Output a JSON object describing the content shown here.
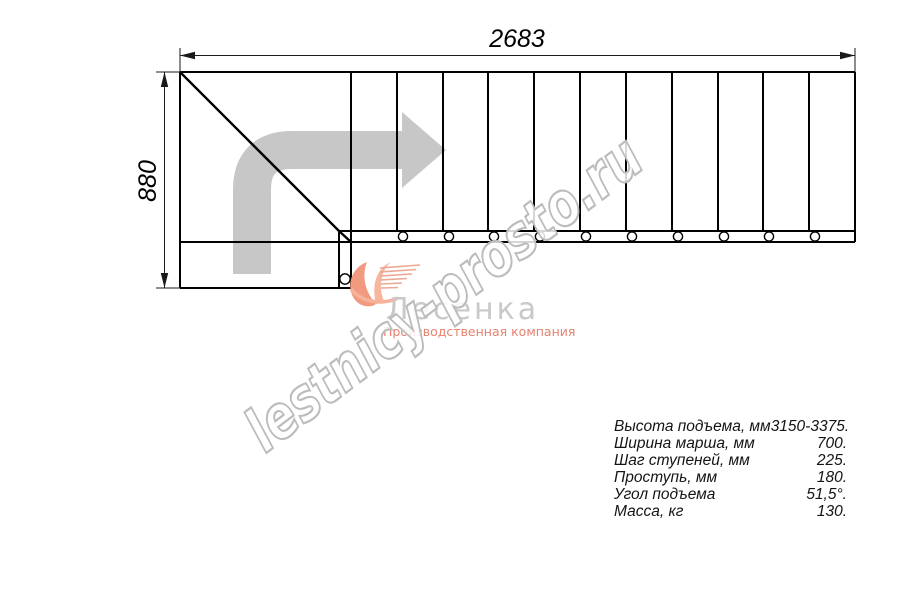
{
  "drawing": {
    "dim_width": "2683",
    "dim_height": "880",
    "step_count": 11,
    "arrow_color": "#c7c7c7",
    "line_color": "#000000"
  },
  "logo": {
    "name": "Лесенка",
    "tagline": "Производственная компания",
    "accent_color": "#f19a80",
    "name_color": "#c9c9c9"
  },
  "watermark": "lestnicy-prosto.ru",
  "specs": {
    "rows": [
      {
        "label": "Высота подъема, мм",
        "value": "3150-3375."
      },
      {
        "label": "Ширина марша, мм",
        "value": "700."
      },
      {
        "label": "Шаг ступеней, мм",
        "value": "225."
      },
      {
        "label": "Проступь, мм",
        "value": "180."
      },
      {
        "label": "Угол подъема",
        "value": "51,5°."
      },
      {
        "label": "Масса, кг",
        "value": "130."
      }
    ]
  }
}
